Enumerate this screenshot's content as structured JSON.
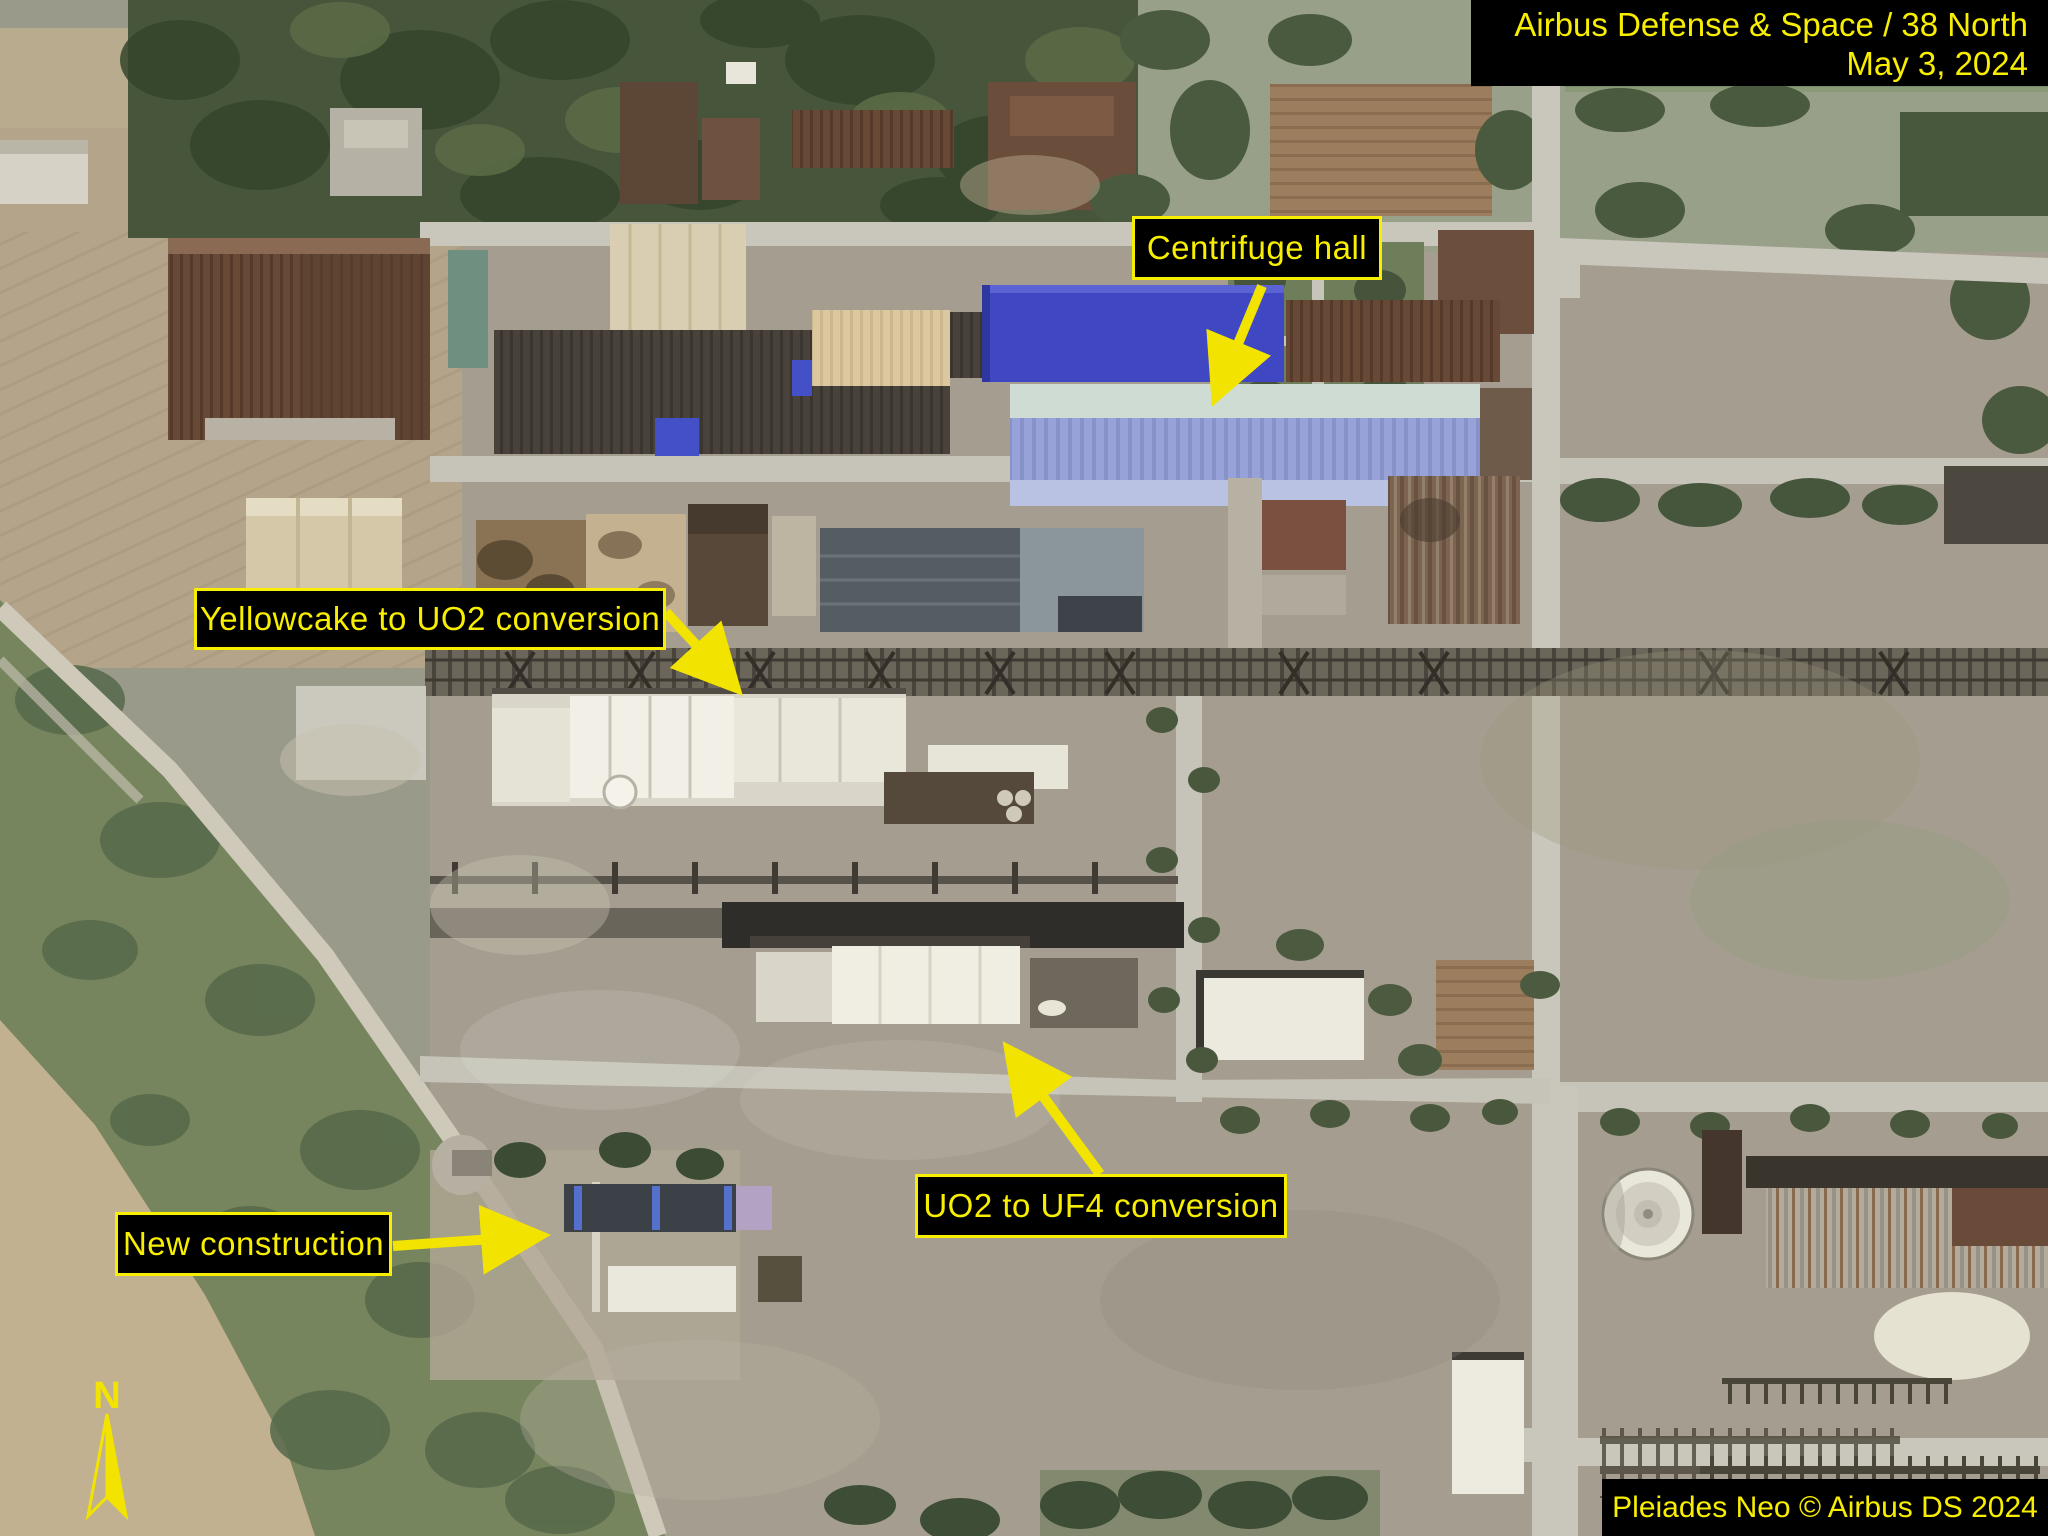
{
  "credit_box": {
    "line1": "Airbus Defense & Space / 38 North",
    "line2": "May 3, 2024"
  },
  "source_box": {
    "text": "Pleiades Neo © Airbus DS 2024"
  },
  "annotations": {
    "centrifuge_hall": "Centrifuge hall",
    "yellowcake_uo2": "Yellowcake to UO2 conversion",
    "uo2_uf4": "UO2 to UF4 conversion",
    "new_construction": "New construction"
  },
  "compass": {
    "north_label": "N"
  },
  "colors": {
    "annotation_yellow": "#f8ee00",
    "box_background": "#000000",
    "centrifuge_roof_blue": "#3f48c2",
    "hall_periwinkle": "#96a2d8",
    "hall_seafoam": "#cfdcd3"
  }
}
